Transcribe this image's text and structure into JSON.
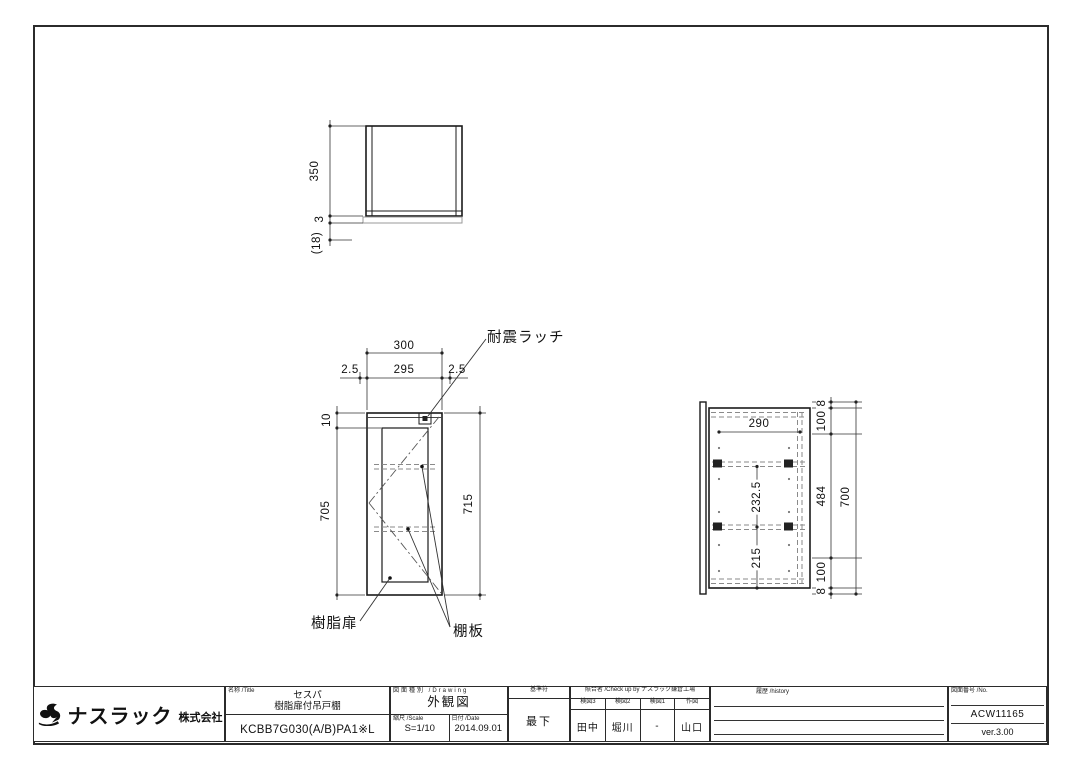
{
  "annotations": {
    "latch": "耐震ラッチ",
    "resin_door": "樹脂扉",
    "shelf_board": "棚板"
  },
  "top_view": {
    "depth": "350",
    "panel": "3",
    "overhang": "(18)"
  },
  "front_view": {
    "width_outer": "300",
    "gap_left": "2.5",
    "door_width": "295",
    "gap_right": "2.5",
    "top_offset": "10",
    "door_height": "705",
    "overall_height": "715"
  },
  "side_view": {
    "inner_width": "290",
    "shelf_span": "232.5",
    "bottom_span": "215",
    "lip_top": "8",
    "margin_top": "100",
    "mid_span": "484",
    "margin_bottom": "100",
    "lip_bottom": "8",
    "carcass_height": "700"
  },
  "title_block": {
    "company": {
      "name": "ナスラック",
      "suffix": "株式会社",
      "logo": "swan-mark"
    },
    "title_label": "名称  /Title",
    "product_series": "セスパ",
    "product_name": "樹脂扉付吊戸棚",
    "model": "KCBB7G030(A/B)PA1※L",
    "drawing_type_label": "図面種別  /Drawing",
    "drawing_type": "外観図",
    "scale_label": "縮尺  /Scale",
    "scale": "S=1/10",
    "date_label": "日付  /Date",
    "date": "2014.09.01",
    "ref_label": "基準符",
    "ref_value": "最下",
    "check_label": "照合者  /Check up by  ナスラック鎌倉工場",
    "checkers": {
      "headers": [
        "検図3",
        "検図2",
        "検図1",
        "作図"
      ],
      "values": [
        "田中",
        "堀川",
        "-",
        "山口"
      ]
    },
    "history_label": "履歴  /history",
    "no_label": "図面番号  /No.",
    "drawing_no": "ACW11165",
    "version": "ver.3.00"
  }
}
